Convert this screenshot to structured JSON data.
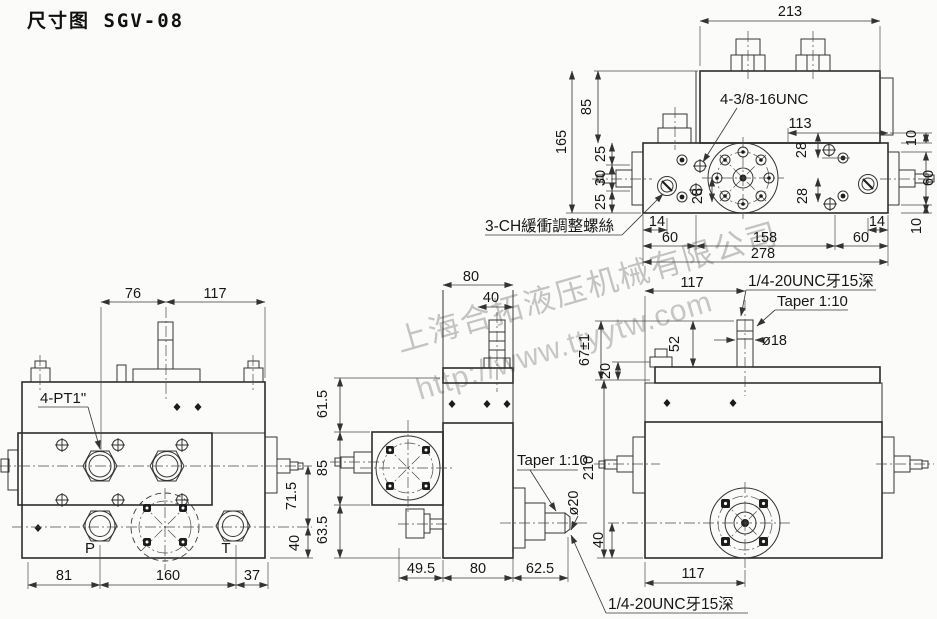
{
  "title": "尺寸图 SGV-08",
  "colors": {
    "ink": "#2e2e2e",
    "watermark": "#c4c4c2",
    "background": "#fbfbf9"
  },
  "watermark": {
    "company": "上海合拓液压机械有限公司",
    "url": "http://www.ttyytw.com"
  },
  "top": {
    "d213": "213",
    "d85": "85",
    "d165": "165",
    "d25a": "25",
    "d30": "30",
    "d25b": "25",
    "d113": "113",
    "d10a": "10",
    "d60r": "60",
    "d10b": "10",
    "d28a": "28",
    "d28b": "28",
    "d28c": "28",
    "d14l": "14",
    "d60bl": "60",
    "d158": "158",
    "d60br": "60",
    "d14r": "14",
    "d278": "278",
    "thread": "4-3/8-16UNC",
    "cushion": "3-CH緩衝調整螺絲"
  },
  "mid": {
    "d80t": "80",
    "d40t": "40",
    "d61": "61.5",
    "d85": "85",
    "d63": "63.5",
    "taper": "Taper 1:10",
    "phi20": "ø20",
    "d49": "49.5",
    "d80b": "80",
    "d62": "62.5",
    "thread": "1/4-20UNC牙15深"
  },
  "right": {
    "d117t": "117",
    "thread": "1/4-20UNC牙15深",
    "taper": "Taper 1:10",
    "phi18": "ø18",
    "d67": "67±1",
    "d52": "52",
    "d20": "20",
    "d210": "210",
    "d40": "40",
    "d117b": "117"
  },
  "front": {
    "d76": "76",
    "d117": "117",
    "ports": "4-PT1\"",
    "p": "P",
    "t": "T",
    "d81": "81",
    "d160": "160",
    "d37": "37",
    "d71": "71.5",
    "d40": "40"
  }
}
